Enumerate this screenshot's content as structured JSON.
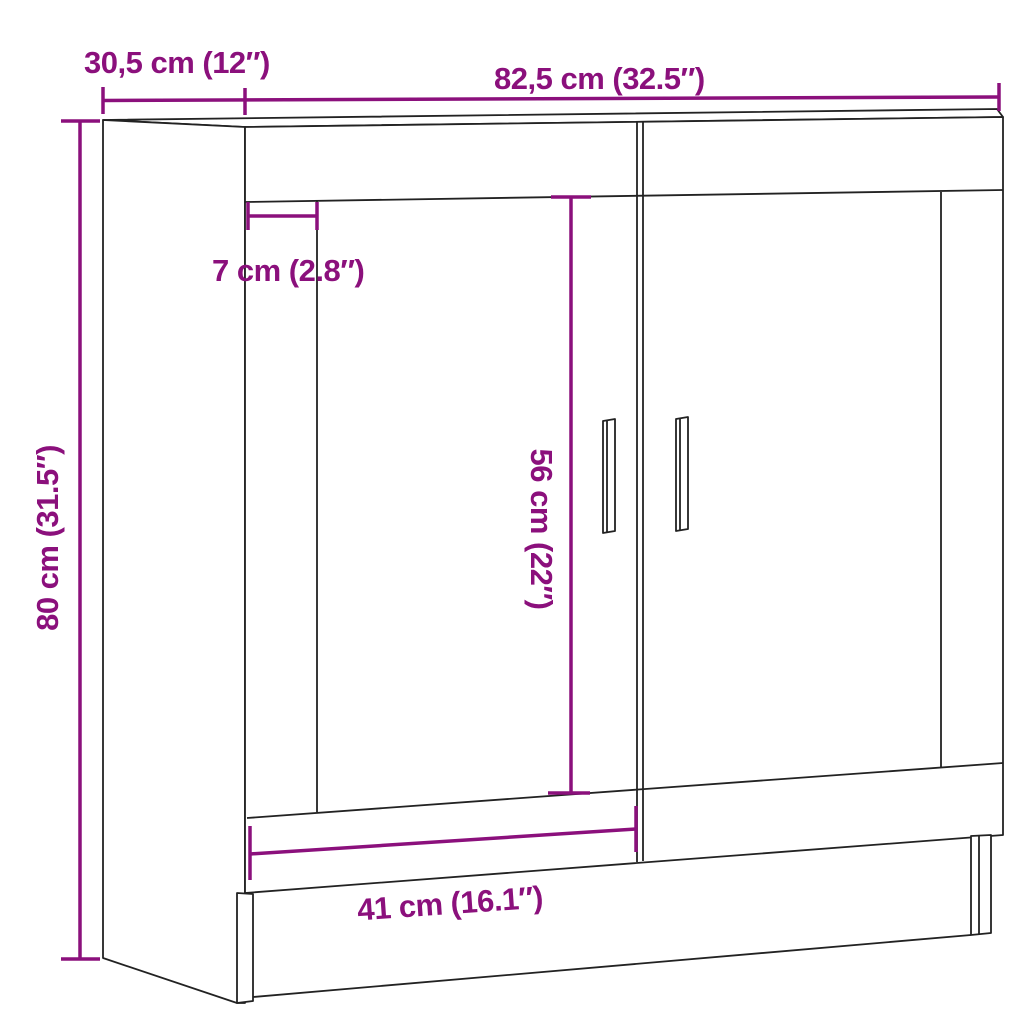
{
  "diagram": {
    "type": "furniture-dimension-diagram",
    "subject": "two-door sideboard cabinet line drawing",
    "colors": {
      "accent": "#8B107C",
      "line": "#222222",
      "background": "#FFFFFF"
    },
    "measurements": {
      "width": {
        "label": "82,5 cm (32.5″)",
        "cm": 82.5,
        "inches": 32.5
      },
      "depth": {
        "label": "30,5 cm (12″)",
        "cm": 30.5,
        "inches": 12
      },
      "height": {
        "label": "80 cm (31.5″)",
        "cm": 80,
        "inches": 31.5
      },
      "frame_inset": {
        "label": "7 cm (2.8″)",
        "cm": 7,
        "inches": 2.8
      },
      "door_height": {
        "label": "56 cm (22″)",
        "cm": 56,
        "inches": 22
      },
      "door_width": {
        "label": "41 cm (16.1″)",
        "cm": 41,
        "inches": 16.1
      }
    }
  }
}
